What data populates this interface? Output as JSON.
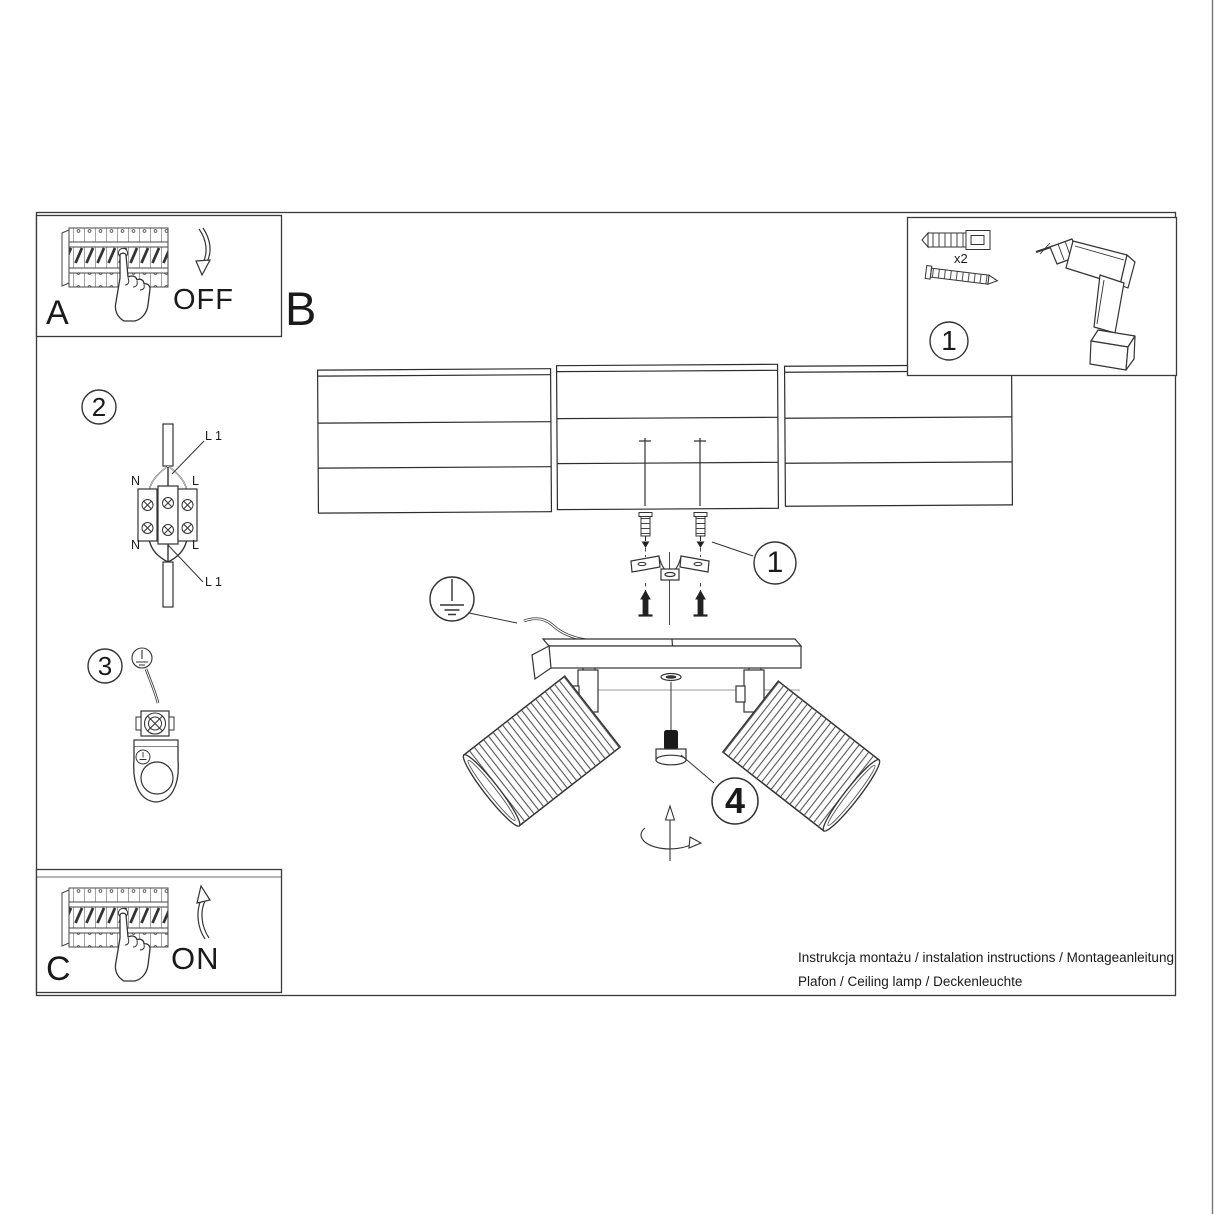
{
  "colors": {
    "line": "#3a3a3a",
    "text": "#1a1a1a",
    "background": "#ffffff"
  },
  "panels": {
    "a": {
      "label": "A",
      "action": "OFF"
    },
    "b": {
      "label": "B"
    },
    "c": {
      "label": "C",
      "action": "ON"
    }
  },
  "steps": {
    "s1": "1",
    "s2": "2",
    "s3": "3",
    "s4": "4"
  },
  "tools": {
    "anchor_qty": "x2"
  },
  "wiring": {
    "line1": "L 1",
    "neutral": "N",
    "live": "L"
  },
  "footer": {
    "line1": "Instrukcja montażu / instalation instructions / Montageanleitung",
    "line2": "Plafon / Ceiling lamp / Deckenleuchte"
  }
}
